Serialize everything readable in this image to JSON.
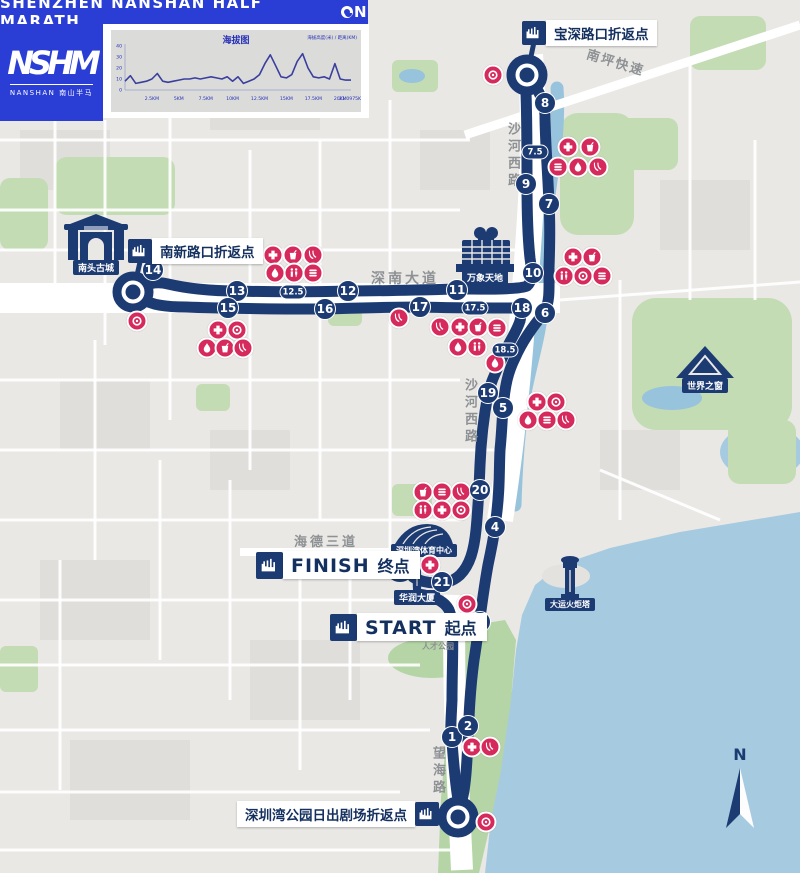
{
  "banner": {
    "title_left": "SHENZHEN NANSHAN HALF MARATH",
    "title_right": "N"
  },
  "logo": {
    "acronym": "NSHM",
    "sub": "NANSHAN 南山半马"
  },
  "chart": {
    "title": "海拔图",
    "note": "海拔高度(米) / 距离(KM)",
    "x_ticks": [
      {
        "label": "2.5KM",
        "km": 2.5
      },
      {
        "label": "5KM",
        "km": 5
      },
      {
        "label": "7.5KM",
        "km": 7.5
      },
      {
        "label": "10KM",
        "km": 10
      },
      {
        "label": "12.5KM",
        "km": 12.5
      },
      {
        "label": "15KM",
        "km": 15
      },
      {
        "label": "17.5KM",
        "km": 17.5
      },
      {
        "label": "20KM",
        "km": 20
      },
      {
        "label": "21.0975KM",
        "km": 21.0975
      }
    ],
    "y_ticks": [
      {
        "label": "40",
        "v": 40
      },
      {
        "label": "30",
        "v": 30
      },
      {
        "label": "20",
        "v": 20
      },
      {
        "label": "10",
        "v": 10
      },
      {
        "label": "0",
        "v": 0
      }
    ]
  },
  "chart_data": {
    "type": "line",
    "title": "海拔图",
    "xlabel": "距离(KM)",
    "ylabel": "海拔(米)",
    "x_range_km": [
      0,
      21
    ],
    "ylim": [
      0,
      40
    ],
    "step": 0.5,
    "values": [
      8,
      13,
      6,
      7,
      8,
      10,
      15,
      8,
      7,
      8,
      9,
      10,
      10,
      11,
      10,
      11,
      12,
      11,
      10,
      12,
      8,
      12,
      6,
      8,
      10,
      14,
      24,
      32,
      22,
      12,
      11,
      14,
      26,
      33,
      20,
      12,
      11,
      12,
      10,
      24,
      10,
      9,
      9
    ]
  },
  "map": {
    "turnarounds": [
      {
        "id": "baoshen",
        "label": "宝深路口折返点"
      },
      {
        "id": "nanxin",
        "label": "南新路口折返点"
      },
      {
        "id": "sunrise",
        "label": "深圳湾公园日出剧场折返点"
      }
    ],
    "start": {
      "word": "START",
      "cn": "起点"
    },
    "finish": {
      "word": "FINISH",
      "cn": "终点"
    },
    "landmarks": [
      {
        "id": "nantou",
        "label": "南头古城"
      },
      {
        "id": "mixc",
        "label": "万象天地"
      },
      {
        "id": "wow",
        "label": "世界之窗"
      },
      {
        "id": "sportscenter",
        "label": "深圳湾体育中心"
      },
      {
        "id": "crtower",
        "label": "华润大厦"
      },
      {
        "id": "torch",
        "label": "大运火炬塔"
      }
    ],
    "road_labels": [
      {
        "text": "南坪快速",
        "x": 586,
        "y": 52,
        "rotate": 17,
        "vertical": false,
        "size": 13,
        "spacing": 2
      },
      {
        "text": "沙河西路",
        "x": 503,
        "y": 122,
        "rotate": 0,
        "vertical": true,
        "size": 13,
        "spacing": 4
      },
      {
        "text": "深南大道",
        "x": 371,
        "y": 268,
        "rotate": 0,
        "vertical": false,
        "size": 14,
        "spacing": 3
      },
      {
        "text": "沙河西路",
        "x": 460,
        "y": 378,
        "rotate": 0,
        "vertical": true,
        "size": 13,
        "spacing": 4
      },
      {
        "text": "海德三道",
        "x": 294,
        "y": 531,
        "rotate": 0,
        "vertical": false,
        "size": 13,
        "spacing": 3
      },
      {
        "text": "望海路",
        "x": 428,
        "y": 746,
        "rotate": 0,
        "vertical": true,
        "size": 13,
        "spacing": 4
      }
    ],
    "poi_labels": [
      {
        "text": "人才公园",
        "x": 422,
        "y": 641,
        "size": 8
      }
    ],
    "km_markers": [
      {
        "label": "1",
        "x": 452,
        "y": 737,
        "half": false
      },
      {
        "label": "2",
        "x": 468,
        "y": 726,
        "half": false
      },
      {
        "label": "3",
        "x": 480,
        "y": 622,
        "half": false
      },
      {
        "label": "4",
        "x": 495,
        "y": 527,
        "half": false
      },
      {
        "label": "5",
        "x": 503,
        "y": 408,
        "half": false
      },
      {
        "label": "6",
        "x": 545,
        "y": 313,
        "half": false
      },
      {
        "label": "7",
        "x": 549,
        "y": 204,
        "half": false
      },
      {
        "label": "7.5",
        "x": 535,
        "y": 152,
        "half": true
      },
      {
        "label": "8",
        "x": 545,
        "y": 103,
        "half": false
      },
      {
        "label": "9",
        "x": 526,
        "y": 184,
        "half": false
      },
      {
        "label": "10",
        "x": 533,
        "y": 273,
        "half": false
      },
      {
        "label": "11",
        "x": 457,
        "y": 290,
        "half": false
      },
      {
        "label": "12",
        "x": 348,
        "y": 291,
        "half": false
      },
      {
        "label": "12.5",
        "x": 293,
        "y": 292,
        "half": true
      },
      {
        "label": "13",
        "x": 237,
        "y": 291,
        "half": false
      },
      {
        "label": "14",
        "x": 153,
        "y": 270,
        "half": false
      },
      {
        "label": "15",
        "x": 228,
        "y": 308,
        "half": false
      },
      {
        "label": "16",
        "x": 325,
        "y": 309,
        "half": false
      },
      {
        "label": "17",
        "x": 420,
        "y": 307,
        "half": false
      },
      {
        "label": "17.5",
        "x": 475,
        "y": 308,
        "half": true
      },
      {
        "label": "18",
        "x": 522,
        "y": 308,
        "half": false
      },
      {
        "label": "18.5",
        "x": 505,
        "y": 350,
        "half": true
      },
      {
        "label": "19",
        "x": 488,
        "y": 393,
        "half": false
      },
      {
        "label": "20",
        "x": 480,
        "y": 490,
        "half": false
      },
      {
        "label": "21",
        "x": 442,
        "y": 582,
        "half": false
      }
    ],
    "stations": [
      {
        "t": "photo",
        "x": 493,
        "y": 75
      },
      {
        "t": "medical",
        "x": 568,
        "y": 147
      },
      {
        "t": "drink",
        "x": 590,
        "y": 147
      },
      {
        "t": "food",
        "x": 558,
        "y": 167
      },
      {
        "t": "water",
        "x": 578,
        "y": 167
      },
      {
        "t": "banana",
        "x": 598,
        "y": 167
      },
      {
        "t": "medical",
        "x": 573,
        "y": 257
      },
      {
        "t": "drink",
        "x": 592,
        "y": 257
      },
      {
        "t": "toilet",
        "x": 564,
        "y": 276
      },
      {
        "t": "photo",
        "x": 583,
        "y": 276
      },
      {
        "t": "food",
        "x": 602,
        "y": 276
      },
      {
        "t": "medical",
        "x": 273,
        "y": 255
      },
      {
        "t": "drink",
        "x": 293,
        "y": 255
      },
      {
        "t": "banana",
        "x": 313,
        "y": 255
      },
      {
        "t": "water",
        "x": 275,
        "y": 273
      },
      {
        "t": "toilet",
        "x": 294,
        "y": 273
      },
      {
        "t": "food",
        "x": 313,
        "y": 273
      },
      {
        "t": "photo",
        "x": 137,
        "y": 321
      },
      {
        "t": "medical",
        "x": 218,
        "y": 330
      },
      {
        "t": "photo",
        "x": 237,
        "y": 330
      },
      {
        "t": "water",
        "x": 207,
        "y": 348
      },
      {
        "t": "drink",
        "x": 225,
        "y": 348
      },
      {
        "t": "banana",
        "x": 243,
        "y": 348
      },
      {
        "t": "banana",
        "x": 399,
        "y": 318
      },
      {
        "t": "banana",
        "x": 440,
        "y": 327
      },
      {
        "t": "medical",
        "x": 460,
        "y": 327
      },
      {
        "t": "drink",
        "x": 478,
        "y": 327
      },
      {
        "t": "food",
        "x": 497,
        "y": 328
      },
      {
        "t": "water",
        "x": 458,
        "y": 347
      },
      {
        "t": "toilet",
        "x": 477,
        "y": 347
      },
      {
        "t": "water",
        "x": 495,
        "y": 363
      },
      {
        "t": "medical",
        "x": 537,
        "y": 402
      },
      {
        "t": "photo",
        "x": 556,
        "y": 402
      },
      {
        "t": "water",
        "x": 528,
        "y": 420
      },
      {
        "t": "food",
        "x": 547,
        "y": 420
      },
      {
        "t": "banana",
        "x": 566,
        "y": 420
      },
      {
        "t": "drink",
        "x": 423,
        "y": 492
      },
      {
        "t": "food",
        "x": 442,
        "y": 492
      },
      {
        "t": "banana",
        "x": 461,
        "y": 492
      },
      {
        "t": "toilet",
        "x": 423,
        "y": 510
      },
      {
        "t": "medical",
        "x": 442,
        "y": 510
      },
      {
        "t": "photo",
        "x": 461,
        "y": 510
      },
      {
        "t": "photo",
        "x": 410,
        "y": 565
      },
      {
        "t": "medical",
        "x": 430,
        "y": 565
      },
      {
        "t": "photo",
        "x": 467,
        "y": 604
      },
      {
        "t": "medical",
        "x": 461,
        "y": 625
      },
      {
        "t": "medical",
        "x": 472,
        "y": 747
      },
      {
        "t": "banana",
        "x": 490,
        "y": 747
      },
      {
        "t": "photo",
        "x": 486,
        "y": 822
      }
    ],
    "compass": {
      "label": "N"
    }
  },
  "colors": {
    "banner_blue": "#2a3ed6",
    "route_navy": "#1d3b73",
    "station_red": "#d62a5c",
    "sea": "#a6cbe0",
    "park_green": "#c3dcb4",
    "land": "#e9e8e5"
  }
}
